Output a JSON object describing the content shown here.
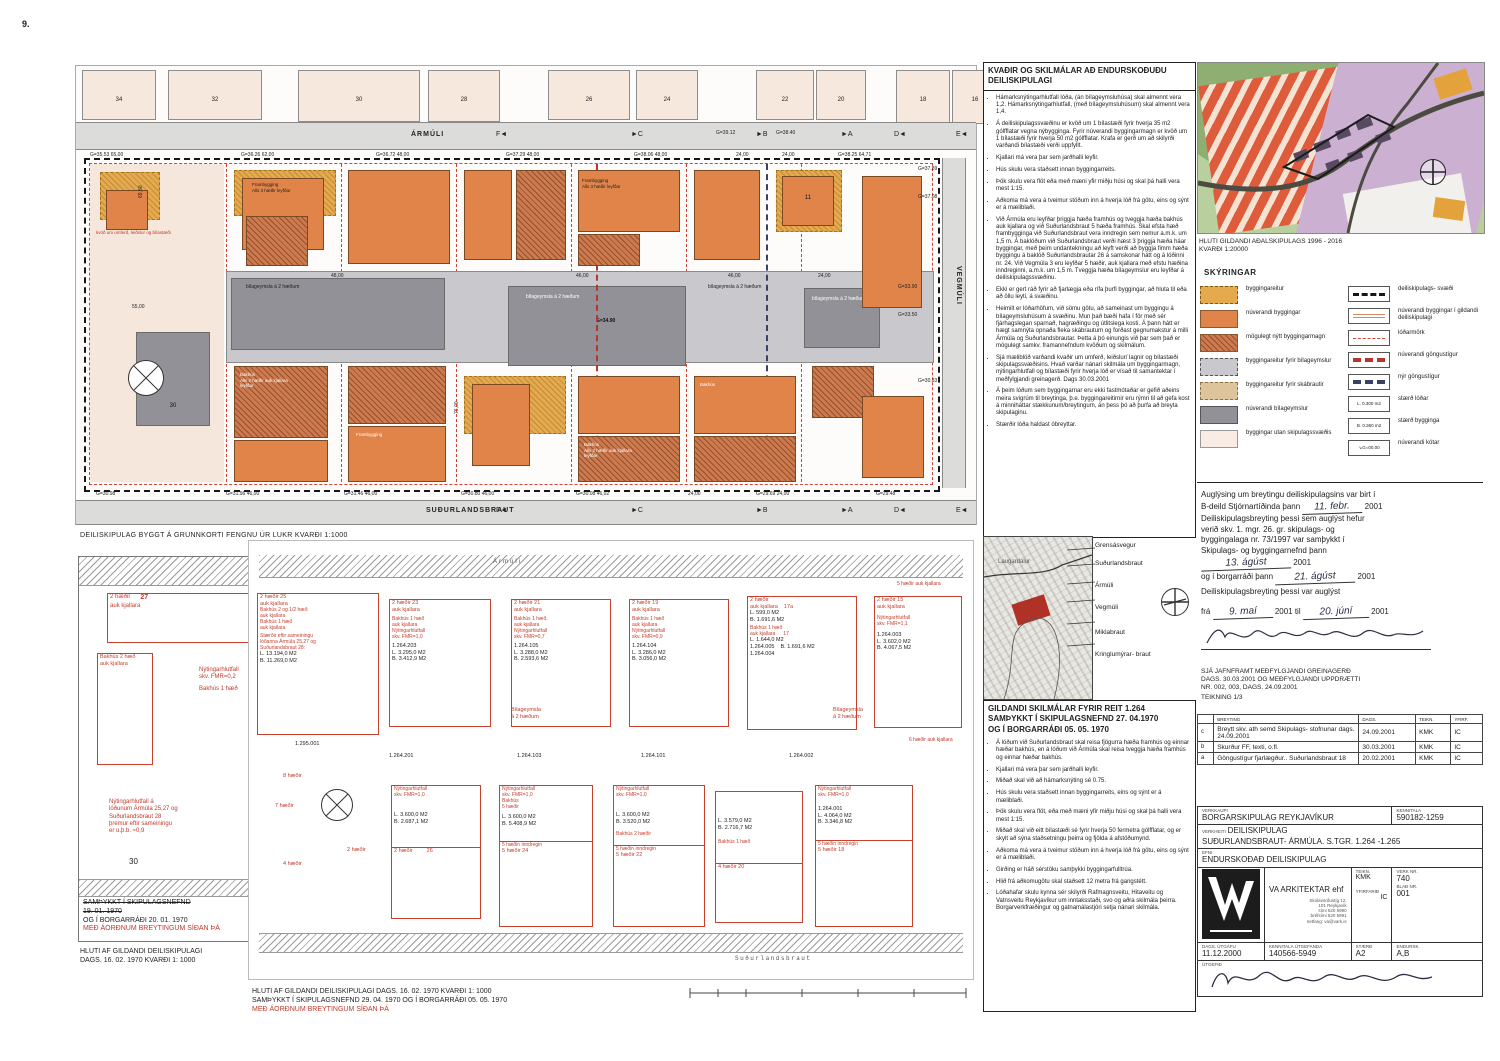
{
  "page": {
    "num": "9."
  },
  "top_plan": {
    "street_top": "ÁRMÚLI",
    "street_bottom": "SUÐURLANDSBRAUT",
    "street_right": "VEGMÚLI",
    "outside": [
      "34",
      "32",
      "30",
      "28",
      "26",
      "24",
      "22",
      "20",
      "18",
      "16"
    ],
    "markers": [
      "F◄",
      "►C",
      "►B",
      "►A",
      "D◄",
      "E◄"
    ],
    "dims_top": [
      "G=35.53  65,00",
      "G=36.26  62,00",
      "G=36.72  48,00",
      "G=37.29  48,00",
      "G=38.06  48,00",
      "24,00",
      "24,00",
      "G=38.25  64,71"
    ],
    "dims_top_extra": [
      "G=39.12",
      "G=38.40"
    ],
    "dims_bottom": [
      "G=30.98",
      "G=31.96  46,00",
      "G=31.46  46,00",
      "G=30.80  46,00",
      "G=30.08  46,02",
      "24,00",
      "G=29.69  24,00",
      "G=29.48"
    ],
    "dims_right": [
      "G=37.89",
      "G=37.08",
      "G=33.90",
      "G=33.50",
      "G=30.33"
    ],
    "center_dims": [
      "48,00",
      "46,00",
      "46,00",
      "24,00",
      "24,00"
    ],
    "spot": "G=34.90",
    "dim_5500": "55,00",
    "dim_14350": "143,50",
    "dim_7600": "76,00",
    "dim_6950": "69,50",
    "dim_6850a": "68,50",
    "dim_6850b": "68,50",
    "dim_6850c": "68,50",
    "labels": {
      "bilageymsla": "bílageymsla á 2 hæðum",
      "kvod": "kvöð um umferð, leiðslur og bílastæði",
      "frambygging": "Frambygging",
      "alls3": "Alls 3 hæðir leyfðar",
      "bakhus": "Bakhús",
      "alls2": "Alls 2 hæðir auk kjallara leyfðar",
      "lot30": "30",
      "lot11": "11"
    }
  },
  "captions": {
    "top_plan": "DEILISKIPULAG BYGGT Á GRUNNKORTI  FENGNU ÚR LUKR  KVARÐI 1:1000",
    "left_old_1": "SAMÞYKKT Í SKIPULAGSNEFND",
    "left_old_2": "19. 01. 1970",
    "left_old_3": "OG Í BORGARRÁÐI 20. 01. 1970",
    "left_old_4": "MEÐ ÁORÐNUM BREYTINGUM SÍÐAN ÞÁ",
    "left_old_5": "HLUTI AF GILDANDI DEILISKIPULAGI",
    "left_old_6": "DAGS. 16. 02. 1970  KVARÐI 1: 1000",
    "bottom_plan_1": "HLUTI AF GILDANDI DEILISKIPULAGI DAGS. 16. 02. 1970  KVARÐI 1: 1000",
    "bottom_plan_2": "SAMÞYKKT Í SKIPULAGSNEFND 29. 04. 1970 OG Í BORGARRÁÐI 05. 05. 1970",
    "bottom_plan_3": "MEÐ ÁORÐNUM BREYTINGUM SÍÐAN ÞÁ"
  },
  "left_old": {
    "lot27_l1": "2 hæðir",
    "lot27_num": "27",
    "lot27_l2": "auk kjallara",
    "bak_l1": "Bakhús 2 hæð",
    "bak_l2": "auk kjallara",
    "fmr_l1": "Nýtingarhlutfall",
    "fmr_l2": "skv. FMR=0,2",
    "fmr_l3": "Bakhús 1 hæð",
    "note": [
      "Nýtingarhlutfall á",
      "lóðunum Ármúla 25,27 og",
      "Suðurlandsbraut 28",
      "þremur eftir sameiningu",
      "er u.þ.b. ≈0,9"
    ],
    "lot30": "30"
  },
  "bottom_plan": {
    "street_top": "Ármúli",
    "street_bottom": "Suðurlandsbraut",
    "lot25": {
      "red": [
        "2 hæðir  25",
        "auk kjallara",
        "Bakhús 2 og 1/2 hæð",
        "auk kjallara",
        "Bakhús 1 hæð",
        "auk kjallara",
        "Stærðir eftir sameiningu",
        "lóðanna Ármúla 25,27 og",
        "Suðurlandsbraut 28:"
      ],
      "a1": "L. 13.194,0 M2",
      "a2": "B. 11.269,0 M2"
    },
    "lot23": {
      "r1": "2 hæðir  23",
      "r2": "auk kjallara",
      "r3": "Bakhús 1 hæð",
      "r4": "auk kjallara",
      "r5": "Nýtingarhlutfall",
      "r6": "skv. FMR=1,0",
      "p": "1.264.203",
      "a1": "L. 3.295,0 M2",
      "a2": "B. 3.412,9 M2"
    },
    "lot21": {
      "r1": "2 hæðir  21",
      "r2": "auk kjallara",
      "r3": "Bakhús 1 hæð,",
      "r4": "auk kjallara",
      "r5": "Nýtingarhlutfall",
      "r6": "skv. FMR=0,7",
      "p": "1.264.105",
      "a1": "L. 3.288,0 M2",
      "a2": "B. 2.593,6 M2"
    },
    "lot19": {
      "r1": "2 hæðir  19",
      "r2": "auk kjallara",
      "r3": "Bakhús 1 hæð",
      "r4": "auk kjallara",
      "r5": "Nýtingarhlutfall",
      "r6": "skv. FMR=0,9",
      "p": "1.264.104",
      "a1": "L. 3.286,0 M2",
      "a2": "B. 3.056,0 M2"
    },
    "lot17": {
      "r1": "2 hæðir",
      "r2": "auk kjallara",
      "r3": "17a",
      "a1": "L. 599,0 M2",
      "a2": "B. 1.691,6 M2",
      "r4": "Bakhús 1 hæð",
      "r5": "auk kjallara",
      "r6": "17",
      "a3": "L. 1.644,0 M2",
      "a4": "B. 1.691,6 M2",
      "p1": "1.264.005",
      "p2": "1.264.004"
    },
    "lot15": {
      "r1": "2 hæðir  15",
      "r2": "auk kjallara",
      "r3": "Nýtingarhlutfall",
      "r4": "skv. FMR=1,1",
      "p": "1.264.003",
      "a1": "L. 3.602,0 M2",
      "a2": "B. 4.067,5 M2"
    },
    "extra1": "5 hæðir auk kjallara",
    "extra2": "6 hæðir auk kjallara",
    "garage1": "Bílageymsla",
    "garage2": "á 2 hæðum",
    "parcels": [
      "1.264.201",
      "1.264.103",
      "1.264.101",
      "1.264.002"
    ],
    "lot26": {
      "r1": "Nýtingarhlutfall",
      "r2": "skv. FMR=1,0",
      "a1": "L. 3.600,0 M2",
      "a2": "B. 2.687,1 M2",
      "r3": "2 hæðir",
      "r4": "26"
    },
    "lot24": {
      "r1": "Nýtingarhlutfall",
      "r2": "skv. FMR=1,0",
      "r3": "Bakhús",
      "r4": "5 hæðir",
      "a1": "L. 3.600,0 M2",
      "a2": "B. 5.408,9 M2",
      "r5": "5 hæðin inndregin",
      "r6": "5 hæðir  24"
    },
    "lot22": {
      "r1": "Nýtingarhlutfall",
      "r2": "skv. FMR=1,0",
      "a1": "L. 3.600,0 M2",
      "a2": "B. 3.520,0 M2",
      "r3": "Bakhús 2 hæðir",
      "r4": "5 hæðin inndregin",
      "r5": "5 hæðir  22"
    },
    "lot20": {
      "a1": "L. 3.579,0 M2",
      "a2": "B. 2.716,7 M2",
      "r1": "Bakhús 1 hæð",
      "r2": "4 hæðir  20"
    },
    "lot18": {
      "r1": "Nýtingarhlutfall",
      "r2": "skv. FMR=1,0",
      "p": "1.264.001",
      "a1": "L. 4.064,0 M2",
      "a2": "B. 3.346,8 M2",
      "r3": "5 hæðin inndregin",
      "r4": "5 hæðir  18"
    },
    "left_labels": {
      "p": "1.295.001",
      "h8": "8 hæðir",
      "h7": "7 hæðir",
      "h4": "4 hæðir",
      "h2": "2 hæðir"
    }
  },
  "kvadir": {
    "t1": "KVAÐIR OG SKILMÁLAR  AÐ ENDURSKOÐUÐU",
    "t2": "DEILISKIPULAGI",
    "bullets": [
      "Hámarksnýtingarhlutfall lóða, (án bílageymsluhúsa) skal almennt vera 1,2.  Hámarksnýtingarhlutfall, (með bílageymsluhúsum) skal almennt vera 1,4.",
      "Á deiliskipulagssvæðinu er kvöð um 1 bílastæði fyrir hverja 35 m2 gólfflatar vegna nýbygginga. Fyrir núverandi byggingarmagn er kvöð um 1 bílastæði fyrir hverja 50 m2 gólfflatar.  Krafa er gerð um að skilyrði varðandi bílastæði verði uppfyllt.",
      "Kjallari má vera þar sem jarðhalli leyfir.",
      "Hús skulu vera staðsett innan byggingarreits.",
      "Þök skulu vera flöt eða með mæni yfir miðju húsi og skal þá halli vera mest 1:15.",
      "Aðkoma má vera á tveimur stöðum inn á hverja lóð frá götu, eins og sýnt er á mæliblaði.",
      "Við Ármúla eru leyfðar þriggja hæða framhús og tveggja hæða bakhús auk kjallara og við Suðurlandsbraut 5 hæða framhús.  Skal efsta hæð frambygginga við Suðurlandsbraut vera inndregin sem nemur a.m.k. um 1,5 m.  Á baklóðum við Suðurlandsbraut verði hæst 3 þriggja hæða háar byggingar, með þeim undantekningu að leyft verði að byggja fimm hæða byggingu á baklóð Suðurlandsbrautar 26 á samskonar hátt og á lóðinni nr. 24.  Við Vegmúla 3 eru leyfðar 5 hæðir, auk kjallara með efstu hæðina inndreginni, a.m.k. um 1,5 m. Tveggja hæða bílageymslur eru leyfðar á deiliskipulagssvæðinu.",
      "Ekki er gert ráð fyrir að fjarlægja eða rífa þurfi byggingar, að hluta til eða að öllu leyti, á svæðinu.",
      "Heimilt er lóðarhöfum, við sömu götu, að  sameinast um byggingu á bílageymsluhúsum á svæðinu. Mun það bæði hafa  í för með sér fjárhagslegan sparnað, hagræðingu og útlitslega kosti.  Á þann hátt er hægt samnýta opnaða fleka skábrautum og forðast gegnumakstur á milli Ármúla og Suðurlandsbrautar. Þetta á þó einungis við þar sem það er mögulegt samkv. framannefndum kvöðum og skilmálum.",
      "Sjá mæliblöð varðandi kvaðir um umferð,  leiðslur/ lagnir og bílastæði skipulagssvæðisins. Hvað varðar nánari skilmála um byggingarmagn, nýtingarhlutfall og bílastæði fyrir hverja lóð er vísað til samantektar í meðfylgjandi greinagerð. Dags 30.03.2001",
      "Á þeim lóðum sem byggingarnar eru ekki fastmótaðar er gefið aðeins meira svigrúm til breytinga, þ.e. byggingareitirnir eru rýmri til að gefa kost á minniháttar stækkunum/breytingum, án þess þó að þurfa að breyta skipulaginu.",
      "Stærðir lóða haldast óbreyttar."
    ]
  },
  "locmap": {
    "area": "Laugardalur",
    "streets": [
      "Grensásvegur",
      "Suðurlandsbraut",
      "Ármúli",
      "Vegmúli",
      "Miklabraut",
      "Kringlumýrar- braut"
    ]
  },
  "gildandi": {
    "t1": "GILDANDI SKILMÁLAR FYRIR REIT 1.264",
    "t2": "SAMÞYKKT Í SKIPULAGSNEFND 27. 04.1970",
    "t3": "OG Í BORGARRÁÐI 05. 05. 1970",
    "bullets": [
      "Á lóðum við Suðurlandsbraut skal reisa fjögurra hæða framhús og einnar hæðar bakhús, en á lóðum við Ármúla skal reisa tveggja hæða framhús og einnar hæðar bakhús.",
      "Kjallari má vera þar sem jarðhalli leyfir.",
      "Miðað skal við að hámarksnýting sé 0.75.",
      "Hús skulu vera staðsett innan byggingarreits, eins og sýnt er á mæliblaði.",
      "Þök skulu vera flöt, eða með mæni yfir miðju húsi og skal þá halli vera mest 1:15.",
      "Miðað skal við eitt bílastæði sé fyrir hverja 50 fermetra gólfflatar, og er skylt að sýna staðsetningu þeirra og fjölda á afstöðumynd.",
      "Aðkoma má vera á tveimur stöðum inn á hverja lóð frá götu, eins og sýnt er á mæliblaði.",
      "Girðing er háð sérstöku samþykki byggingarfulltrúa.",
      "Hlið frá aðkomugötu skal staðsett 12 metra frá gangstétt.",
      "Lóðahafar skulu kynna sér skilyrði Rafmagnsveitu, Hitaveitu og Vatnsveitu  Reykjavíkur um inntaksstaði, svo og aðra skilmála þeirra.  Borgarverkfræðingur og gatnamálastjóri setja nánari skilmála."
    ]
  },
  "adal": {
    "cap1": "HLUTI GILDANDI AÐALSKIPULAGS 1996 - 2016",
    "cap2": "KVARÐI 1:20000"
  },
  "skyringar": {
    "title": "SKÝRINGAR",
    "left": [
      "byggingareitur",
      "núverandi byggingar",
      "mögulegt nýtt byggingarmagn",
      "byggingareitur fyrir bílageymslur",
      "byggingareitur fyrir skábrautir",
      "núverandi bílageymslur",
      "byggingar utan skipulagssvæðis"
    ],
    "right": [
      "deiliskipulags- svæði",
      "núverandi byggingar í gildandi deiliskipulagi",
      "lóðarmörk",
      "núverandi göngustígur",
      "nýr göngustígur",
      "stærð lóðar",
      "stærð bygginga",
      "núverandi kótar"
    ],
    "sw_lod": "L. 0.300 m2",
    "sw_bygg": "B. 0.360 m2",
    "sw_kot": "G=00.00"
  },
  "auglysing": {
    "l1": "Auglýsing um breytingu deiliskipulagsins var birt í",
    "l2": "B-deild Stjórnartíðinda þann",
    "d1": "11. febr.",
    "y1": "2001",
    "l3": "Deiliskipulagsbreyting þessi  sem auglýst hefur",
    "l4": "verið skv. 1. mgr. 26. gr. skipulags- og",
    "l5": "byggingalaga  nr. 73/1997 var samþykkt í",
    "l6": "Skipulags- og byggingarnefnd þann",
    "d2": "13. ágúst",
    "y2": "2001",
    "l7": "og í borgarráði þann",
    "d3": "21. ágúst",
    "y3": "2001",
    "l8": "Deiliskipulagsbreyting þessi var auglýst",
    "l9": "frá",
    "d4": "9. maí",
    "y4": "2001 til",
    "d5": "20. júní",
    "y5": "2001"
  },
  "sja": {
    "l1": "SJÁ JAFNFRAMT MEÐFYLGJANDI GREINAGERÐ",
    "l2": "DAGS. 30.03.2001 OG MEÐFYLGJANDI UPPDRÆTTI",
    "l3": "NR. 002, 003, DAGS. 24.09.2001",
    "l4": "TEIKNING 1/3"
  },
  "revisions": {
    "h0": "BREYTING",
    "h1": "DAGS.",
    "h2": "TEIKN.",
    "h3": "YFIRF.",
    "rows": [
      {
        "id": "c",
        "desc": "Breytt skv. ath semd Skipulags- stofnunar dags. 24.09.2001",
        "dags": "24.09.2001",
        "teikn": "KMK",
        "yfirf": "IC"
      },
      {
        "id": "b",
        "desc": "Skurður FF, texti, o.fl.",
        "dags": "30.03.2001",
        "teikn": "KMK",
        "yfirf": "IC"
      },
      {
        "id": "a",
        "desc": "Göngustígur fjarlægður.. Suðurlandsbraut 18",
        "dags": "20.02.2001",
        "teikn": "KMK",
        "yfirf": "IC"
      }
    ]
  },
  "titleblock": {
    "verkkaupi_label": "VERKKAUPI",
    "verkkaupi": "BORGARSKIPULAG REYKJAVÍKUR",
    "kennitala_label": "KENNITALA",
    "kennitala": "590182-1259",
    "verkheiti_label": "VERKHEITI",
    "verkheiti1": "DEILISKIPULAG",
    "verkheiti2": "SUÐURLANDSBRAUT- ÁRMÚLA. S.TGR. 1.264 -1.265",
    "efni_label": "EFNI",
    "efni": "ENDURSKOÐAÐ DEILISKIPULAG",
    "firm": "VA ARKITEKTAR ehf",
    "addr1": "Skólavörðustíg 12,",
    "addr2": "101 Reykjavík",
    "addr3": "sími 520 5990",
    "addr4": "bréfsími 520 5991",
    "addr5": "netfang: va@vark.is",
    "teikn_label": "TEIKN.",
    "teikn": "KMK",
    "yfirf_label": "YFIRFARIÐ",
    "yfirf": "IC",
    "verknr_label": "VERK NR.",
    "verknr": "740",
    "bladnr_label": "BLAÐ NR.",
    "bladnr": "001",
    "dags_label": "DAGS. ÚTGÁFU",
    "dags": "11.12.2000",
    "kt2_label": "KENNITALA ÚTGEFANDA",
    "kt2": "140566-5949",
    "staerd_label": "STÆRÐ",
    "staerd": "A2",
    "endursk_label": "ENDURSK.",
    "endursk": "A,B",
    "utgefid_label": "ÚTGEFIÐ"
  }
}
